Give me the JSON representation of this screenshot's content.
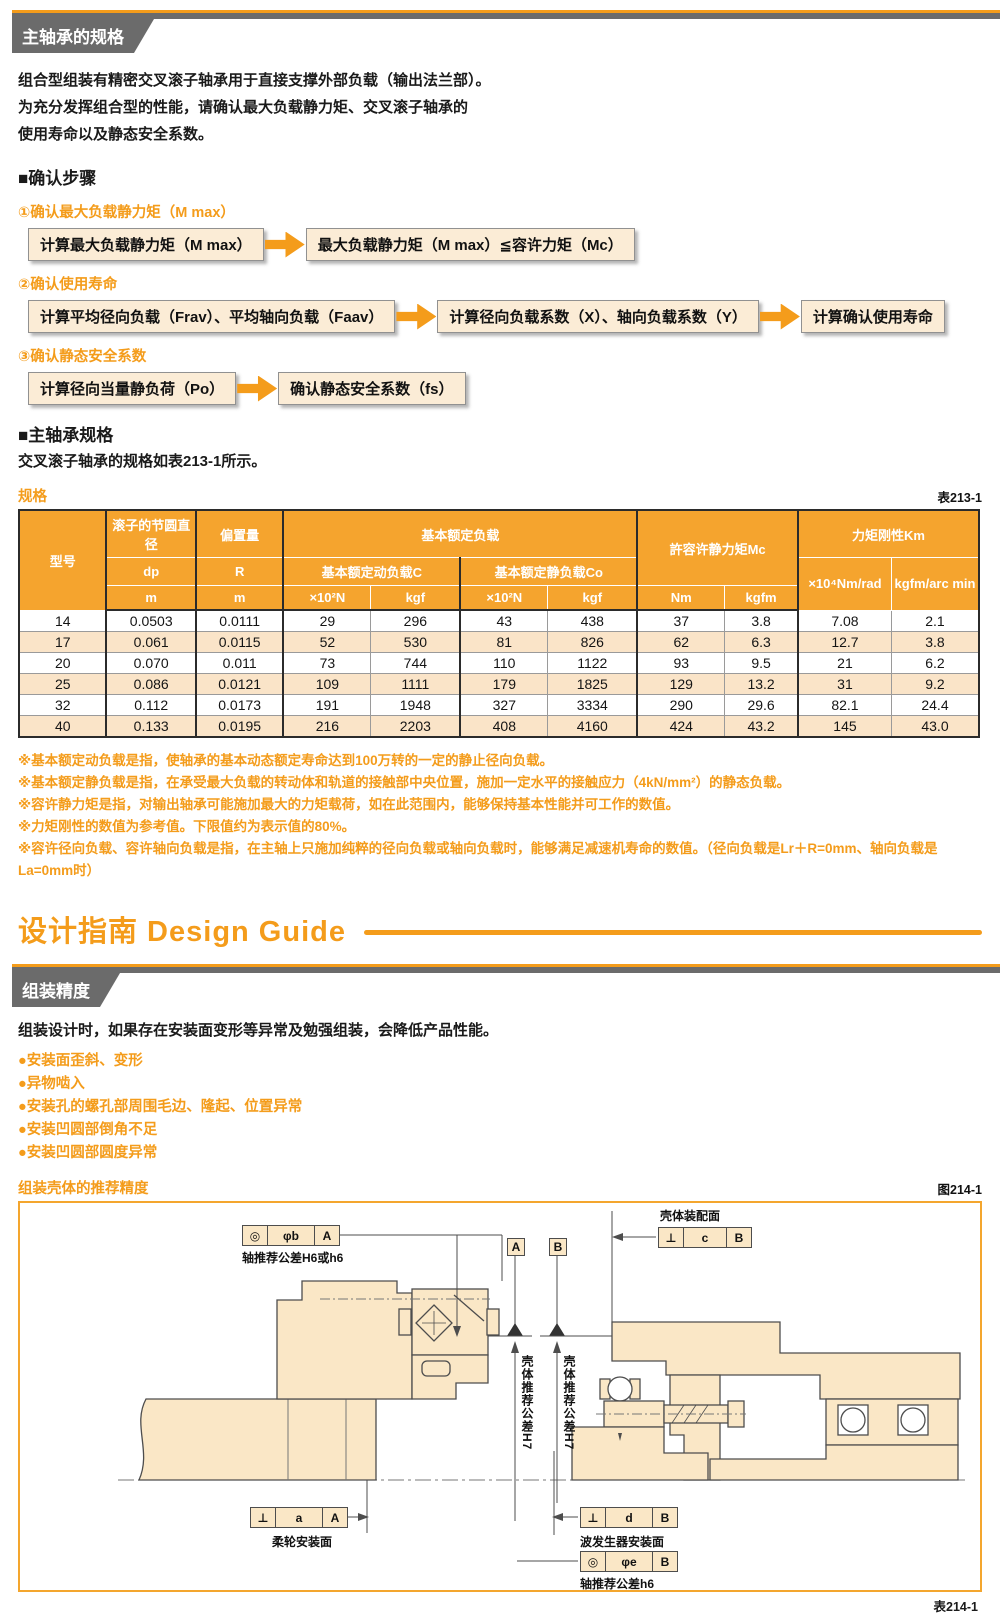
{
  "accent_color": "#F49C1B",
  "header": {
    "title": "主轴承的规格"
  },
  "intro": {
    "lines": [
      "组合型组装有精密交叉滚子轴承用于直接支撑外部负载（输出法兰部）。",
      "为充分发挥组合型的性能，请确认最大负载静力矩、交叉滚子轴承的",
      "使用寿命以及静态安全系数。"
    ]
  },
  "steps": {
    "heading": "■确认步骤",
    "items": [
      {
        "label": "①确认最大负载静力矩（M max）",
        "boxes": [
          "计算最大负载静力矩（M max）",
          "最大负载静力矩（M max）≦容许力矩（Mc）"
        ]
      },
      {
        "label": "②确认使用寿命",
        "boxes": [
          "计算平均径向负载（Frav）、平均轴向负载（Faav）",
          "计算径向负载系数（X）、轴向负载系数（Y）",
          "计算确认使用寿命"
        ]
      },
      {
        "label": "③确认静态安全系数",
        "boxes": [
          "计算径向当量静负荷（Po）",
          "确认静态安全系数（fs）"
        ]
      }
    ]
  },
  "bearing_spec": {
    "heading": "■主轴承规格",
    "text": "交叉滚子轴承的规格如表213-1所示。",
    "table_label": "规格",
    "table_ref": "表213-1"
  },
  "spec_table": {
    "type": "table",
    "headers": {
      "model": "型号",
      "pitch_group": "滚子的节圆直径",
      "pitch_sub": "dp",
      "pitch_unit": "m",
      "offset_group": "偏置量",
      "offset_sub": "R",
      "offset_unit": "m",
      "load_group": "基本额定负载",
      "dynamic_sub": "基本额定动负载C",
      "static_sub": "基本额定静负载Co",
      "unit_n": "×10²N",
      "unit_kgf": "kgf",
      "moment_group": "許容许静力矩Mc",
      "unit_nm": "Nm",
      "unit_kgfm": "kgfm",
      "rigidity_group": "力矩刚性Km",
      "unit_nmrad": "×10⁴Nm/rad",
      "unit_arcmin": "kgfm/arc min"
    },
    "rows": [
      [
        "14",
        "0.0503",
        "0.0111",
        "29",
        "296",
        "43",
        "438",
        "37",
        "3.8",
        "7.08",
        "2.1"
      ],
      [
        "17",
        "0.061",
        "0.0115",
        "52",
        "530",
        "81",
        "826",
        "62",
        "6.3",
        "12.7",
        "3.8"
      ],
      [
        "20",
        "0.070",
        "0.011",
        "73",
        "744",
        "110",
        "1122",
        "93",
        "9.5",
        "21",
        "6.2"
      ],
      [
        "25",
        "0.086",
        "0.0121",
        "109",
        "1111",
        "179",
        "1825",
        "129",
        "13.2",
        "31",
        "9.2"
      ],
      [
        "32",
        "0.112",
        "0.0173",
        "191",
        "1948",
        "327",
        "3334",
        "290",
        "29.6",
        "82.1",
        "24.4"
      ],
      [
        "40",
        "0.133",
        "0.0195",
        "216",
        "2203",
        "408",
        "4160",
        "424",
        "43.2",
        "145",
        "43.0"
      ]
    ]
  },
  "notes": [
    "※基本额定动负载是指，使轴承的基本动态额定寿命达到100万转的一定的静止径向负载。",
    "※基本额定静负载是指，在承受最大负载的转动体和轨道的接触部中央位置，施加一定水平的接触应力（4kN/mm²）的静态负载。",
    "※容许静力矩是指，对输出轴承可能施加最大的力矩载荷，如在此范围内，能够保持基本性能并可工作的数值。",
    "※力矩刚性的数值为参考值。下限值约为表示值的80%。",
    "※容许径向负载、容许轴向负载是指，在主轴上只施加纯粹的径向负载或轴向负载时，能够满足减速机寿命的数值。（径向负载是Lr＋R=0mm、轴向负载是La=0mm时）"
  ],
  "design_guide": {
    "title": "设计指南 Design Guide"
  },
  "assembly": {
    "band_title": "组装精度",
    "intro": "组装设计时，如果存在安装面变形等异常及勉强组装，会降低产品性能。",
    "bullet_icon": "●",
    "bullets": [
      "安装面歪斜、变形",
      "异物啮入",
      "安装孔的螺孔部周围毛边、隆起、位置异常",
      "安装凹圆部倒角不足",
      "安装凹圆部圆度异常"
    ],
    "sub_heading": "组装壳体的推荐精度",
    "fig_ref": "图214-1",
    "bottom_ref": "表214-1"
  },
  "diagram": {
    "fcf_b": {
      "sym": "◎",
      "val": "φb",
      "datum": "A",
      "caption": "轴推荐公差H6或h6"
    },
    "housing_face_label": "壳体装配面",
    "fcf_c": {
      "sym": "⊥",
      "val": "c",
      "datum": "B"
    },
    "datum_a": "A",
    "datum_b": "B",
    "housing_tol_label": "壳体推荐公差H7",
    "fcf_a": {
      "sym": "⊥",
      "val": "a",
      "datum": "A",
      "caption": "柔轮安装面"
    },
    "fcf_d": {
      "sym": "⊥",
      "val": "d",
      "datum": "B",
      "caption": "波发生器安装面"
    },
    "fcf_e": {
      "sym": "◎",
      "val": "φe",
      "datum": "B",
      "caption": "轴推荐公差h6"
    }
  }
}
